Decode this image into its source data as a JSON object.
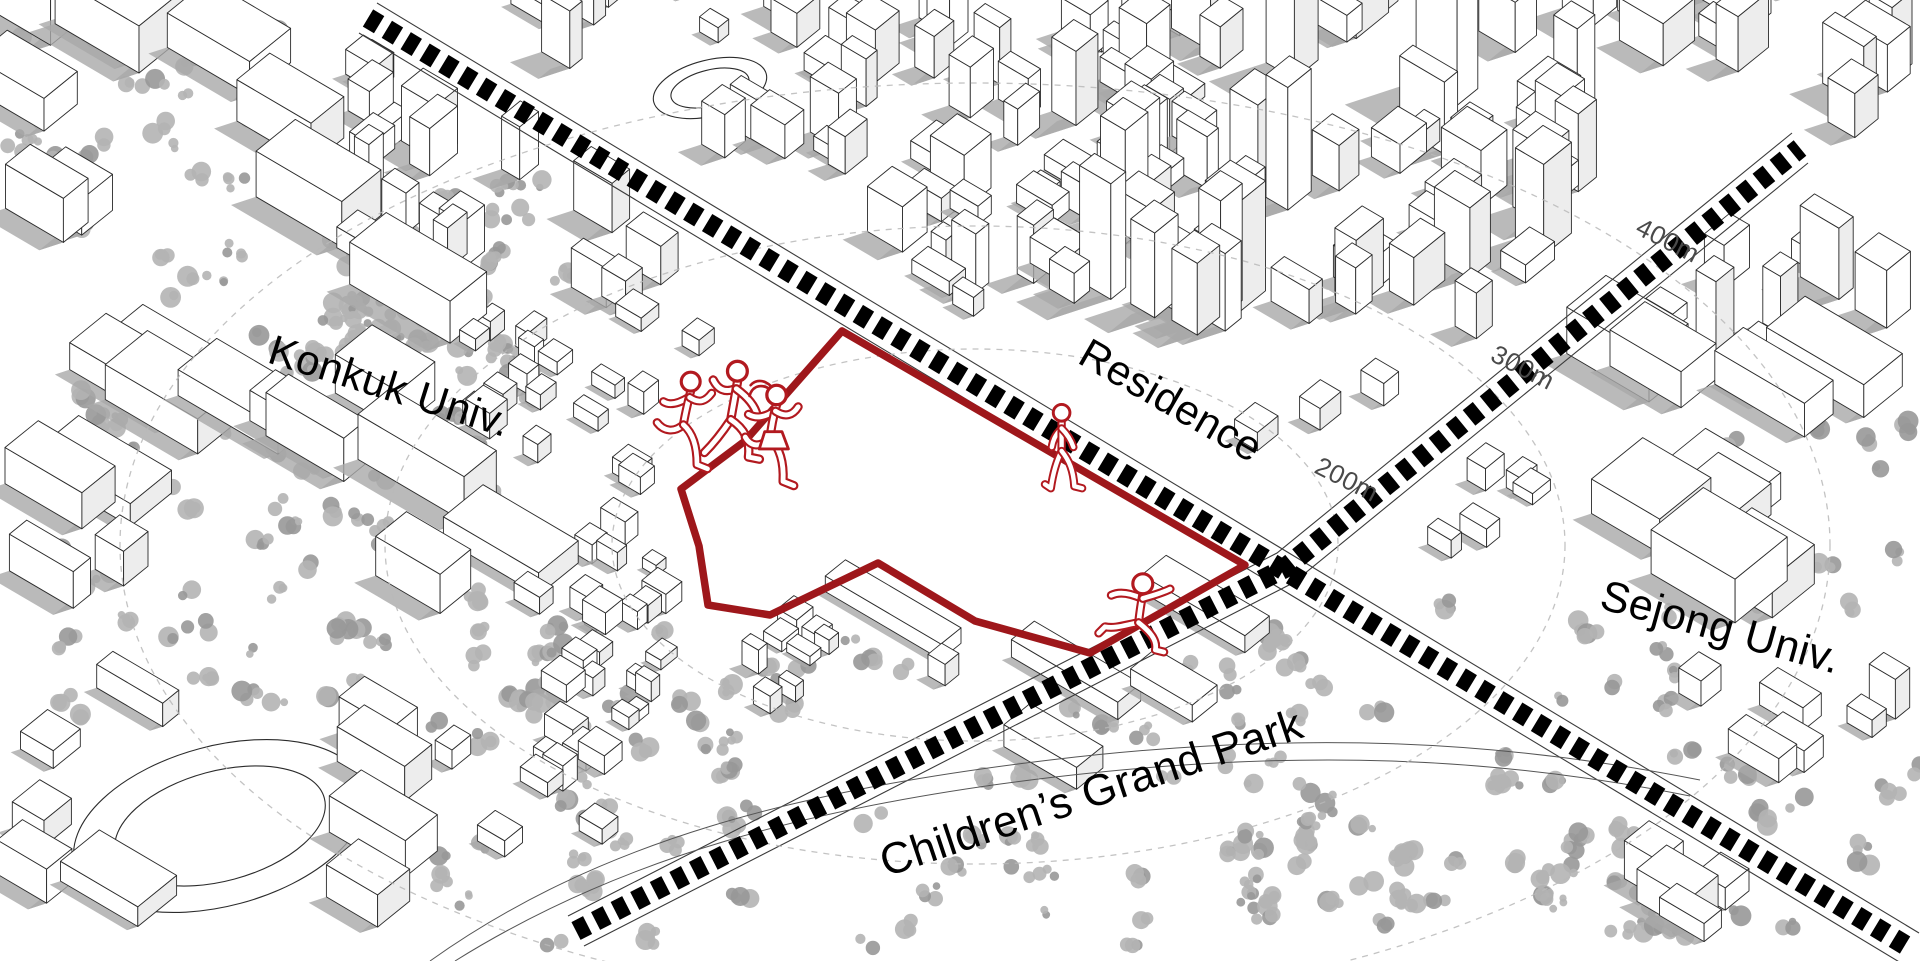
{
  "title": "Site context axonometric map",
  "map": {
    "place_labels": [
      {
        "id": "konkuk",
        "text": "Konkuk Univ."
      },
      {
        "id": "residence",
        "text": "Residence"
      },
      {
        "id": "sejong",
        "text": "Sejong Univ."
      },
      {
        "id": "childrens_park",
        "text": "Children’s Grand Park"
      }
    ],
    "distance_markers": [
      {
        "id": "d200",
        "text": "200m"
      },
      {
        "id": "d300",
        "text": "300m"
      },
      {
        "id": "d400",
        "text": "400m"
      }
    ],
    "figures": [
      {
        "name": "running-child-figure-1"
      },
      {
        "name": "running-child-figure-2"
      },
      {
        "name": "running-child-figure-3"
      },
      {
        "name": "walking-child-figure"
      },
      {
        "name": "jumping-child-figure"
      }
    ],
    "colors": {
      "site_boundary": "#9e171b",
      "figure_outline": "#b2191f",
      "road_dash": "#000000",
      "road_edge_line": "#3a3a3a",
      "building_line": "#2b2b2b",
      "shadow_fill": "#a9a9a9",
      "tree_fill": "#b4b4b4",
      "tree_fill_dark": "#989898",
      "radius_arc": "#b9b9b9",
      "marker_text": "#4a4a4a",
      "label_text": "#000000",
      "background": "#ffffff"
    }
  }
}
